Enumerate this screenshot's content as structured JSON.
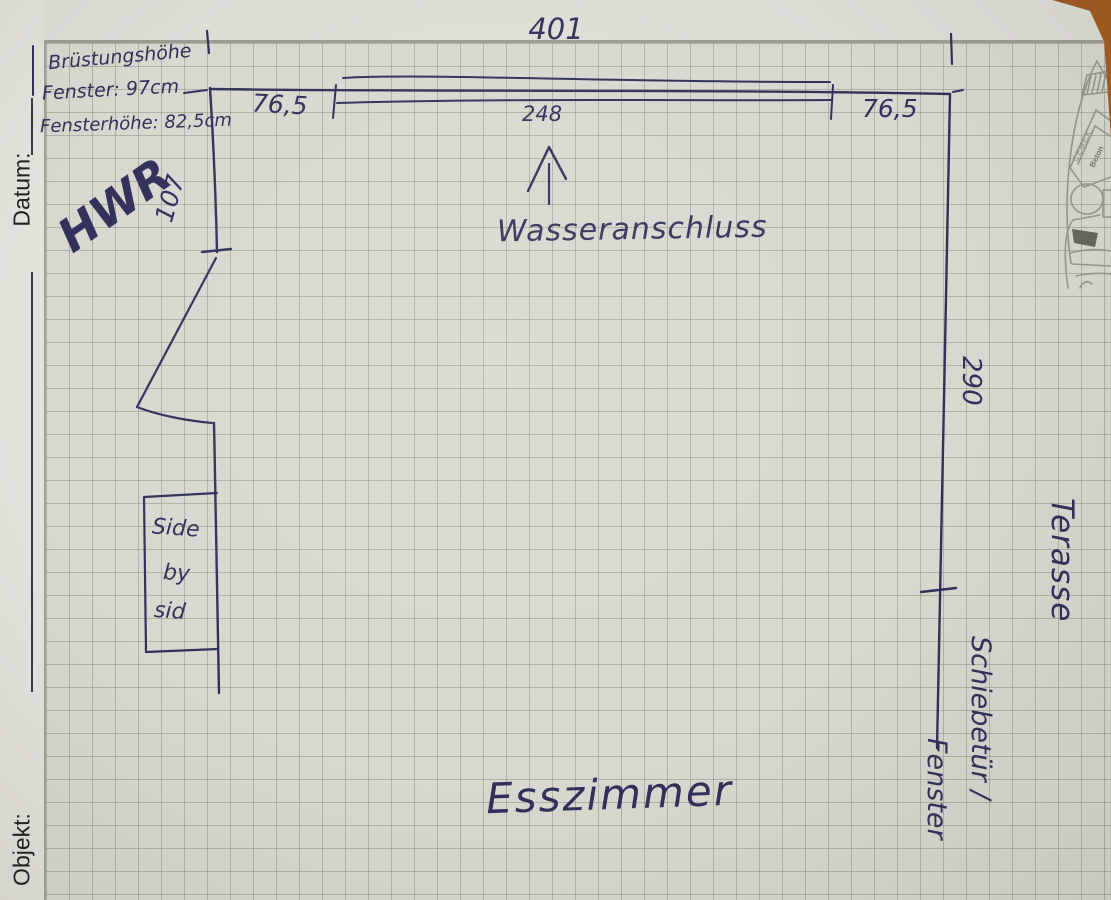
{
  "pad": {
    "date_label": "Datum:",
    "object_label": "Objekt:",
    "logo_brand": "CEMEX",
    "logo_product": "Beton"
  },
  "plan": {
    "room": "Esszimmer",
    "side_room": "HWR",
    "outside": "Terasse",
    "window_note_line1": "Brüstungshöhe",
    "window_note_line2": "Fenster: 97cm",
    "window_note_line3": "Fensterhöhe: 82,5cm",
    "water_note": "Wasseranschluss",
    "door_note_line1": "Schiebetür /",
    "door_note_line2": "Fenster",
    "fridge_line1": "Side",
    "fridge_line2": "by",
    "fridge_line3": "sid",
    "dim_total_width": "401",
    "dim_window_width": "248",
    "dim_left_segment": "76,5",
    "dim_right_segment": "76,5",
    "dim_right_wall": "290",
    "dim_left_wall": "107"
  },
  "ink_color": "#30305a",
  "print_gray": "#96988c"
}
